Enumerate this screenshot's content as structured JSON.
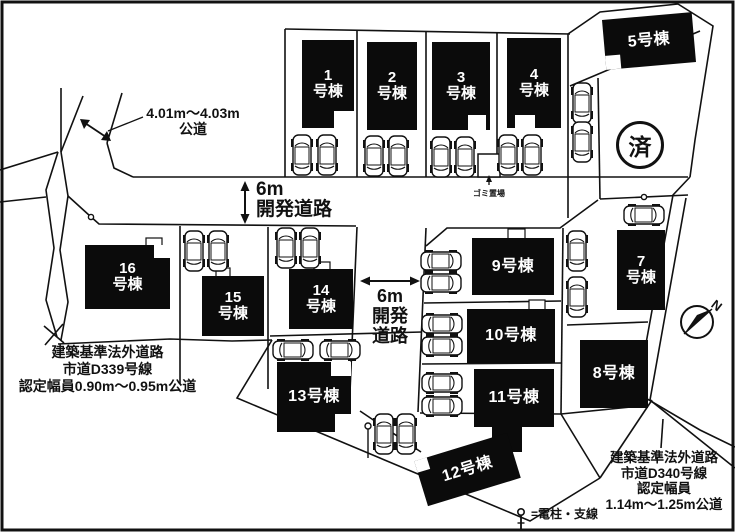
{
  "buildings": [
    {
      "id": "1",
      "label": "1\n号棟"
    },
    {
      "id": "2",
      "label": "2\n号棟"
    },
    {
      "id": "3",
      "label": "3\n号棟"
    },
    {
      "id": "4",
      "label": "4\n号棟"
    },
    {
      "id": "5",
      "label": "5号棟"
    },
    {
      "id": "7",
      "label": "7\n号棟"
    },
    {
      "id": "8",
      "label": "8号棟"
    },
    {
      "id": "9",
      "label": "9号棟"
    },
    {
      "id": "10",
      "label": "10号棟"
    },
    {
      "id": "11",
      "label": "11号棟"
    },
    {
      "id": "12",
      "label": "12号棟"
    },
    {
      "id": "13",
      "label": "13号棟"
    },
    {
      "id": "14",
      "label": "14\n号棟"
    },
    {
      "id": "15",
      "label": "15\n号棟"
    },
    {
      "id": "16",
      "label": "16\n号棟"
    }
  ],
  "annotations": {
    "public_road_top": "4.01m〜4.03m\n公道",
    "dev_road_horizontal": "6m\n開発道路",
    "dev_road_vertical": "6m\n開発\n道路",
    "road_d339": "建築基準法外道路\n市道D339号線\n認定幅員0.90m〜0.95m公道",
    "road_d340": "建築基準法外道路\n市道D340号線\n認定幅員\n1.14m〜1.25m公道",
    "garbage_area": "ゴミ置場",
    "sold_mark": "済",
    "compass_north": "N",
    "legend_pole": "=電柱・支線"
  },
  "colors": {
    "line": "#111111",
    "building": "#0b0b0b",
    "building_text": "#ffffff",
    "background": "#ffffff"
  }
}
